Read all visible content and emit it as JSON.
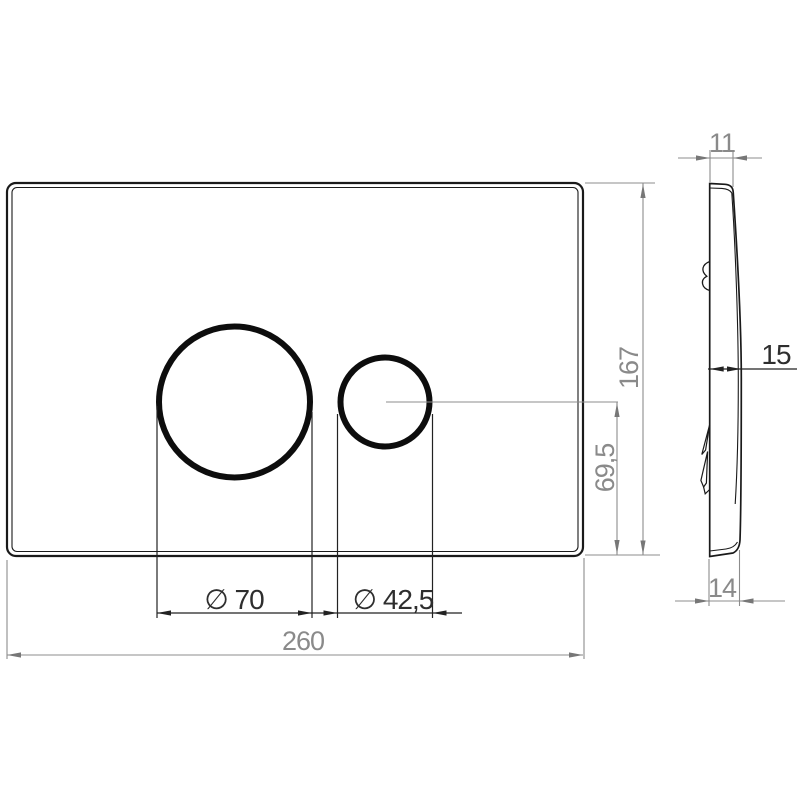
{
  "drawing": {
    "front_view": {
      "width_label": "260",
      "height_label": "167",
      "large_button_diameter_label": "∅ 70",
      "small_button_diameter_label": "∅ 42,5",
      "button_center_height_label": "69,5"
    },
    "side_view": {
      "top_thickness_label": "11",
      "depth_label": "15",
      "bottom_thickness_label": "14"
    },
    "colors": {
      "background": "#ffffff",
      "outline": "#1a1a1a",
      "dark_dimension": "#222222",
      "gray_dimension": "#8c8c8c",
      "gray_text": "#8a8a8a",
      "dark_text": "#2e2e2e"
    }
  }
}
